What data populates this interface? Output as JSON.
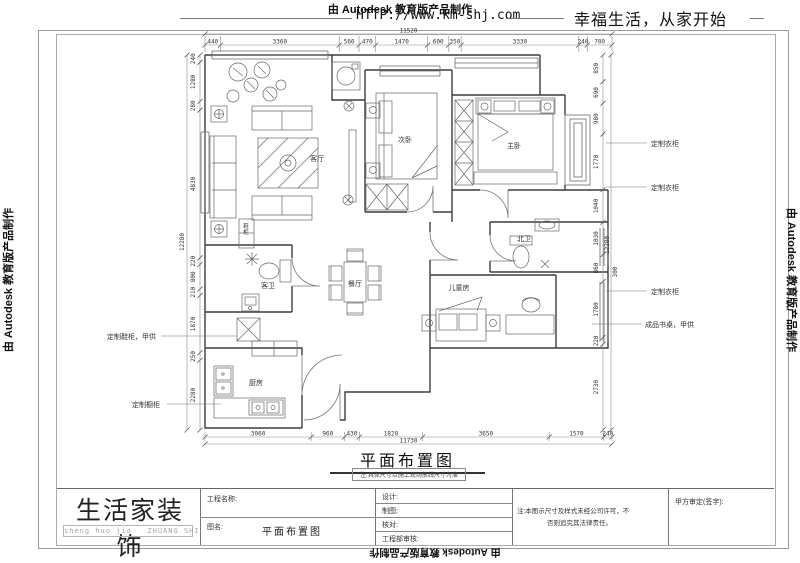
{
  "banner": {
    "autodesk": "由 Autodesk 教育版产品制作",
    "website": "HTTP://www.km-shj.com",
    "slogan": "幸福生活，从家开始"
  },
  "plan": {
    "title": "平面布置图",
    "note": "注:具体尺寸以施工现场放线尺寸为准",
    "rooms": [
      {
        "name": "living-room",
        "label": "客厅",
        "x": 317,
        "y": 161
      },
      {
        "name": "second-bedroom",
        "label": "次卧",
        "x": 405,
        "y": 142
      },
      {
        "name": "master-bedroom",
        "label": "主卧",
        "x": 514,
        "y": 148
      },
      {
        "name": "north-bathroom",
        "label": "北卫",
        "x": 524,
        "y": 241
      },
      {
        "name": "kids-room",
        "label": "儿童房",
        "x": 459,
        "y": 290
      },
      {
        "name": "dining-room",
        "label": "餐厅",
        "x": 355,
        "y": 286
      },
      {
        "name": "guest-bathroom",
        "label": "客卫",
        "x": 268,
        "y": 288
      },
      {
        "name": "kitchen",
        "label": "厨房",
        "x": 256,
        "y": 385
      },
      {
        "name": "hall-cabinet",
        "label": "鞋柜",
        "x": 246,
        "y": 228,
        "v": true
      }
    ],
    "annotations": [
      {
        "name": "custom-wardrobe-1",
        "text": "定制衣柜",
        "x": 651,
        "y": 146,
        "leader": [
          606,
          143,
          647,
          143
        ]
      },
      {
        "name": "custom-wardrobe-2",
        "text": "定制衣柜",
        "x": 651,
        "y": 190,
        "leader": [
          606,
          187,
          647,
          187
        ]
      },
      {
        "name": "custom-wardrobe-3",
        "text": "定制衣柜",
        "x": 651,
        "y": 294,
        "leader": [
          606,
          291,
          647,
          291
        ]
      },
      {
        "name": "finished-desk",
        "text": "成品书桌，甲供",
        "x": 645,
        "y": 327,
        "leader": [
          592,
          324,
          642,
          324
        ]
      },
      {
        "name": "custom-shoe-cabinet",
        "text": "定制鞋柜，甲供",
        "x": 107,
        "y": 339,
        "leader": [
          161,
          336,
          236,
          336
        ]
      },
      {
        "name": "custom-kitchen-cabinet",
        "text": "定制橱柜",
        "x": 132,
        "y": 407,
        "leader": [
          167,
          404,
          221,
          404
        ]
      }
    ],
    "dims": {
      "top": {
        "values": [
          440,
          3360,
          560,
          470,
          1470,
          600,
          350,
          3330,
          240,
          700
        ],
        "overall": "11520"
      },
      "bottom": {
        "values": [
          3060,
          960,
          430,
          1820,
          3650,
          1570,
          240
        ],
        "overall": "11730"
      },
      "left": {
        "values": [
          240,
          1280,
          280,
          4830,
          220,
          800,
          210,
          1870,
          250,
          2280
        ],
        "overall": "12280"
      },
      "right": {
        "values": [
          850,
          690,
          980,
          1770,
          1040,
          1030,
          860,
          1780,
          220,
          2730
        ],
        "overall": "12280",
        "extra": "300"
      }
    }
  },
  "titleblock": {
    "logo": "生活家装饰",
    "logo_sub": "sheng huo jia   ZHUANG SHI",
    "project_label": "工程名称:",
    "drawing_label": "图名:",
    "drawing_name": "平面布置图",
    "fields": [
      "设计:",
      "制图:",
      "核对:",
      "工程部审核:"
    ],
    "copyright_note_1": "注:本图示尺寸及样式未经公司许可，不",
    "copyright_note_2": "否则追究其法律责任。",
    "approval": "甲方审定(签字):"
  }
}
